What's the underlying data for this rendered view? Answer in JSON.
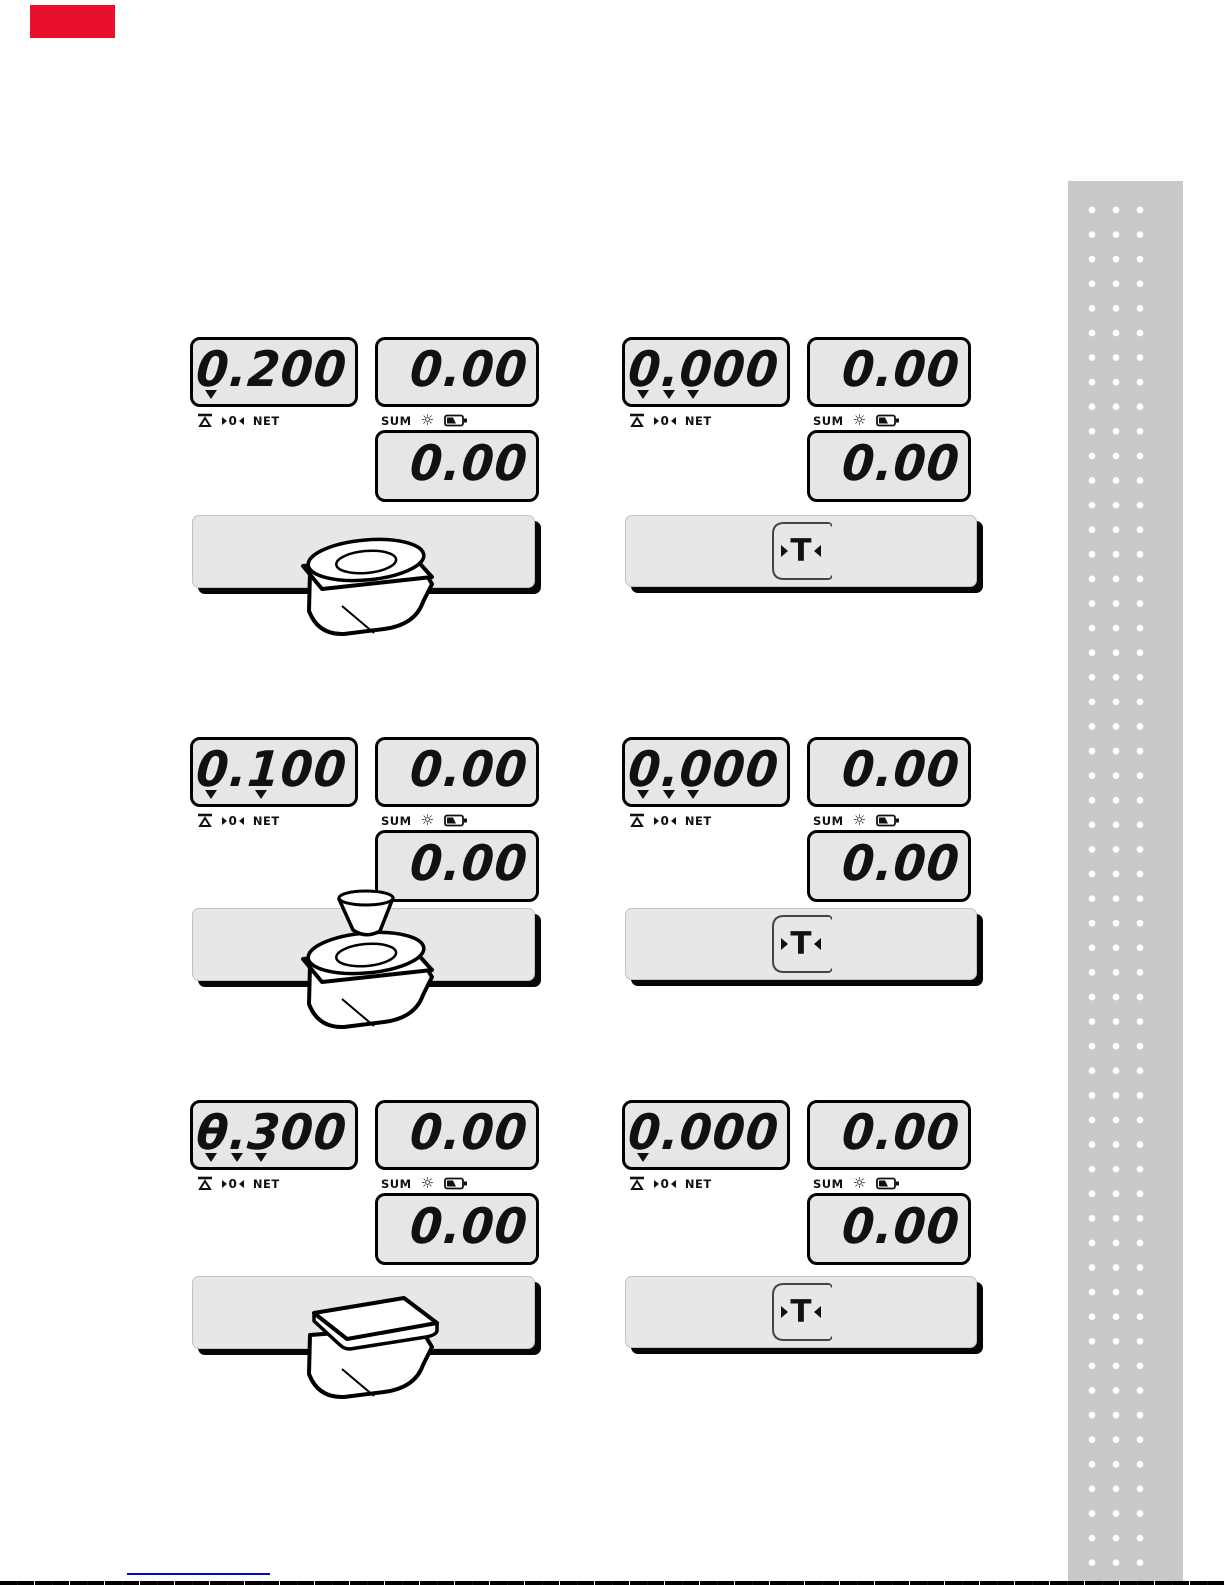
{
  "labels": {
    "net": "NET",
    "sum": "SUM",
    "zero": "0",
    "tare": "T"
  },
  "icons": {
    "gear_char": "☼"
  },
  "colors": {
    "accent_red": "#e8112d",
    "link_blue": "#0008d0",
    "stripe_gray": "#c9c9c9",
    "lcd_bg": "#e6e6e6",
    "bar_bg": "#e7e7e7"
  },
  "groups": [
    {
      "main": {
        "sign": "",
        "value": "0.200",
        "triangles": [
          true,
          false,
          false
        ]
      },
      "sum_top": "0.00",
      "sum_bottom": "0.00",
      "action": "scale-with-round-plate"
    },
    {
      "main": {
        "sign": "",
        "value": "0.000",
        "triangles": [
          true,
          true,
          true
        ]
      },
      "sum_top": "0.00",
      "sum_bottom": "0.00",
      "action": "tare-key"
    },
    {
      "main": {
        "sign": "",
        "value": "0.100",
        "triangles": [
          true,
          false,
          true
        ]
      },
      "sum_top": "0.00",
      "sum_bottom": "0.00",
      "action": "scale-with-bowl"
    },
    {
      "main": {
        "sign": "",
        "value": "0.000",
        "triangles": [
          true,
          true,
          true
        ]
      },
      "sum_top": "0.00",
      "sum_bottom": "0.00",
      "action": "tare-key"
    },
    {
      "main": {
        "sign": "-",
        "value": "0.300",
        "triangles": [
          true,
          true,
          true
        ]
      },
      "sum_top": "0.00",
      "sum_bottom": "0.00",
      "action": "scale-empty-platform"
    },
    {
      "main": {
        "sign": "",
        "value": "0.000",
        "triangles": [
          true,
          false,
          false
        ]
      },
      "sum_top": "0.00",
      "sum_bottom": "0.00",
      "action": "tare-key"
    }
  ]
}
